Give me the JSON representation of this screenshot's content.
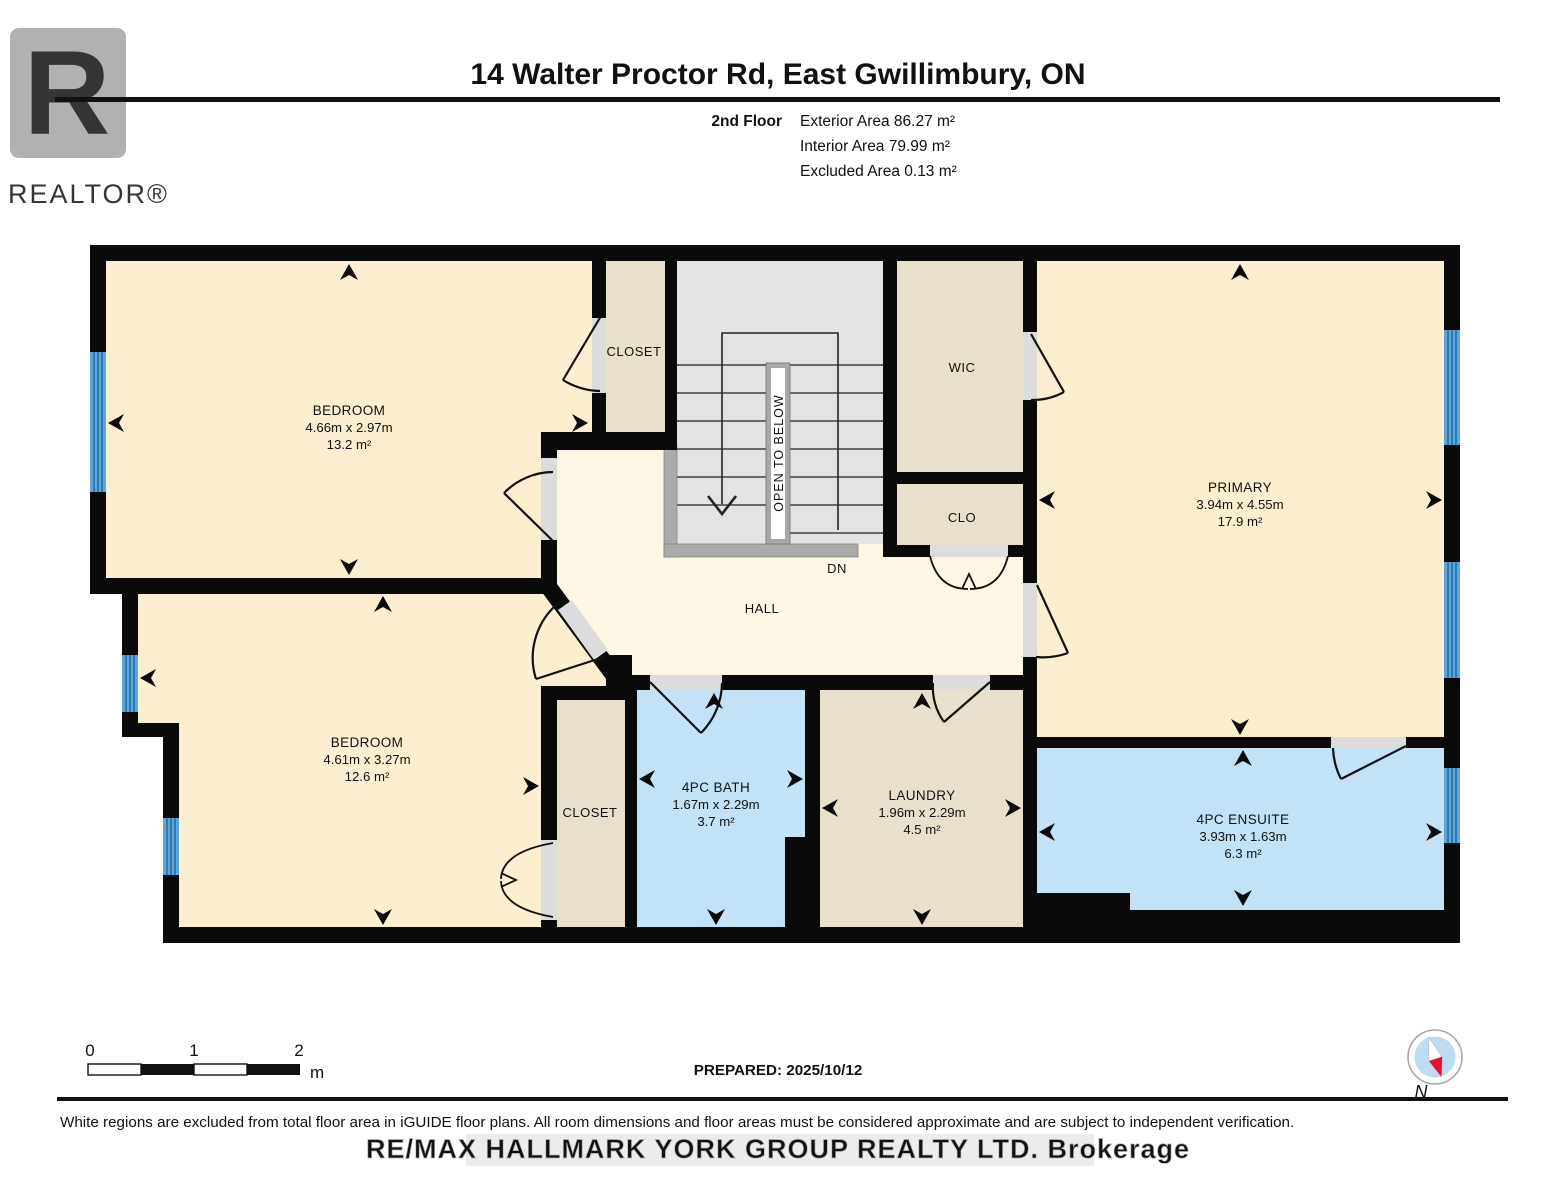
{
  "header": {
    "title": "14 Walter Proctor Rd, East Gwillimbury, ON",
    "logo_letter": "R",
    "logo_text": "REALTOR®"
  },
  "floor_info": {
    "floor_label": "2nd Floor",
    "areas": [
      "Exterior Area 86.27 m²",
      "Interior Area 79.99 m²",
      "Excluded Area 0.13 m²"
    ]
  },
  "rooms": {
    "bedroom1": {
      "name": "BEDROOM",
      "dims": "4.66m x 2.97m",
      "area": "13.2 m²"
    },
    "bedroom2": {
      "name": "BEDROOM",
      "dims": "4.61m x 3.27m",
      "area": "12.6 m²"
    },
    "primary": {
      "name": "PRIMARY",
      "dims": "3.94m x 4.55m",
      "area": "17.9 m²"
    },
    "bath": {
      "name": "4PC BATH",
      "dims": "1.67m x 2.29m",
      "area": "3.7 m²"
    },
    "ensuite": {
      "name": "4PC ENSUITE",
      "dims": "3.93m x 1.63m",
      "area": "6.3 m²"
    },
    "laundry": {
      "name": "LAUNDRY",
      "dims": "1.96m x 2.29m",
      "area": "4.5 m²"
    },
    "closet_top": {
      "name": "CLOSET"
    },
    "closet_bottom": {
      "name": "CLOSET"
    },
    "wic": {
      "name": "WIC"
    },
    "clo": {
      "name": "CLO"
    },
    "hall": {
      "name": "HALL"
    },
    "stairs": {
      "label": "OPEN TO BELOW",
      "direction": "DN"
    }
  },
  "scale_bar": {
    "tick0": "0",
    "tick1": "1",
    "tick2": "2",
    "unit": "m"
  },
  "footer": {
    "prepared": "PREPARED: 2025/10/12",
    "disclaimer": "White regions are excluded from total floor area in iGUIDE floor plans. All room dimensions and floor areas must be considered approximate and are subject to independent verification.",
    "watermark": "RE/MAX HALLMARK YORK GROUP REALTY LTD.  Brokerage",
    "compass_label": "N"
  },
  "colors": {
    "wall": "#0a0a0a",
    "room_fill": "#FCEFD0",
    "hall_fill": "#FEF7E6",
    "closet_fill": "#E8E0CD",
    "stairs_fill": "#E3E3E3",
    "bath_fill": "#C3E2F5",
    "window_blue": "#5CA6D8",
    "window_stripe": "#2A6EA6",
    "compass_red": "#E8112D"
  }
}
